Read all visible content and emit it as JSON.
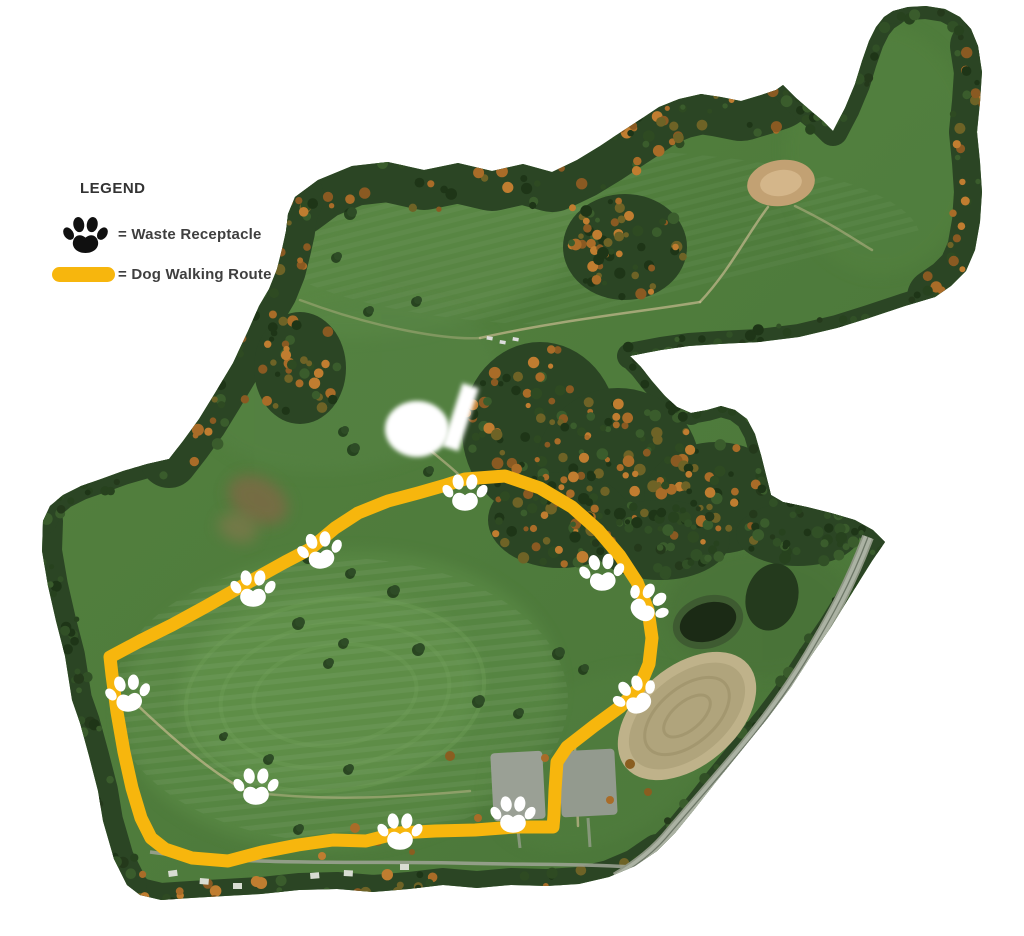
{
  "legend": {
    "title": "LEGEND",
    "items": [
      {
        "icon": "paw-icon",
        "label": "= Waste Receptacle"
      },
      {
        "icon": "route-line-swatch",
        "label": "= Dog Walking Route"
      }
    ]
  },
  "map": {
    "description": "Aerial photo of a park with a marked dog walking loop",
    "background_color": "#ffffff",
    "route": {
      "color": "#F7B60D",
      "stroke_width": 13,
      "closed": true,
      "points": [
        [
          465,
          479
        ],
        [
          505,
          476
        ],
        [
          540,
          488
        ],
        [
          572,
          507
        ],
        [
          598,
          530
        ],
        [
          620,
          556
        ],
        [
          637,
          582
        ],
        [
          648,
          610
        ],
        [
          652,
          638
        ],
        [
          649,
          664
        ],
        [
          639,
          688
        ],
        [
          620,
          707
        ],
        [
          594,
          726
        ],
        [
          567,
          747
        ],
        [
          557,
          762
        ],
        [
          555,
          790
        ],
        [
          554,
          815
        ],
        [
          553,
          827
        ],
        [
          515,
          827
        ],
        [
          475,
          830
        ],
        [
          435,
          831
        ],
        [
          398,
          833
        ],
        [
          366,
          841
        ],
        [
          333,
          840
        ],
        [
          298,
          845
        ],
        [
          262,
          852
        ],
        [
          228,
          861
        ],
        [
          192,
          858
        ],
        [
          165,
          849
        ],
        [
          151,
          838
        ],
        [
          141,
          818
        ],
        [
          132,
          788
        ],
        [
          124,
          752
        ],
        [
          117,
          712
        ],
        [
          112,
          675
        ],
        [
          110,
          657
        ],
        [
          140,
          641
        ],
        [
          172,
          625
        ],
        [
          205,
          607
        ],
        [
          235,
          590
        ],
        [
          258,
          577
        ],
        [
          285,
          562
        ],
        [
          310,
          549
        ],
        [
          335,
          528
        ],
        [
          358,
          513
        ],
        [
          388,
          501
        ],
        [
          418,
          493
        ],
        [
          446,
          485
        ]
      ]
    },
    "waste_receptacle_count": 10,
    "waste_receptacles": [
      {
        "x": 465,
        "y": 492,
        "rotation": 0
      },
      {
        "x": 320,
        "y": 550,
        "rotation": -10
      },
      {
        "x": 253,
        "y": 588,
        "rotation": 0
      },
      {
        "x": 128,
        "y": 693,
        "rotation": -8
      },
      {
        "x": 256,
        "y": 786,
        "rotation": 0
      },
      {
        "x": 400,
        "y": 831,
        "rotation": 0
      },
      {
        "x": 513,
        "y": 814,
        "rotation": 0
      },
      {
        "x": 602,
        "y": 572,
        "rotation": -5
      },
      {
        "x": 648,
        "y": 603,
        "rotation": 38
      },
      {
        "x": 635,
        "y": 695,
        "rotation": -25
      }
    ]
  }
}
